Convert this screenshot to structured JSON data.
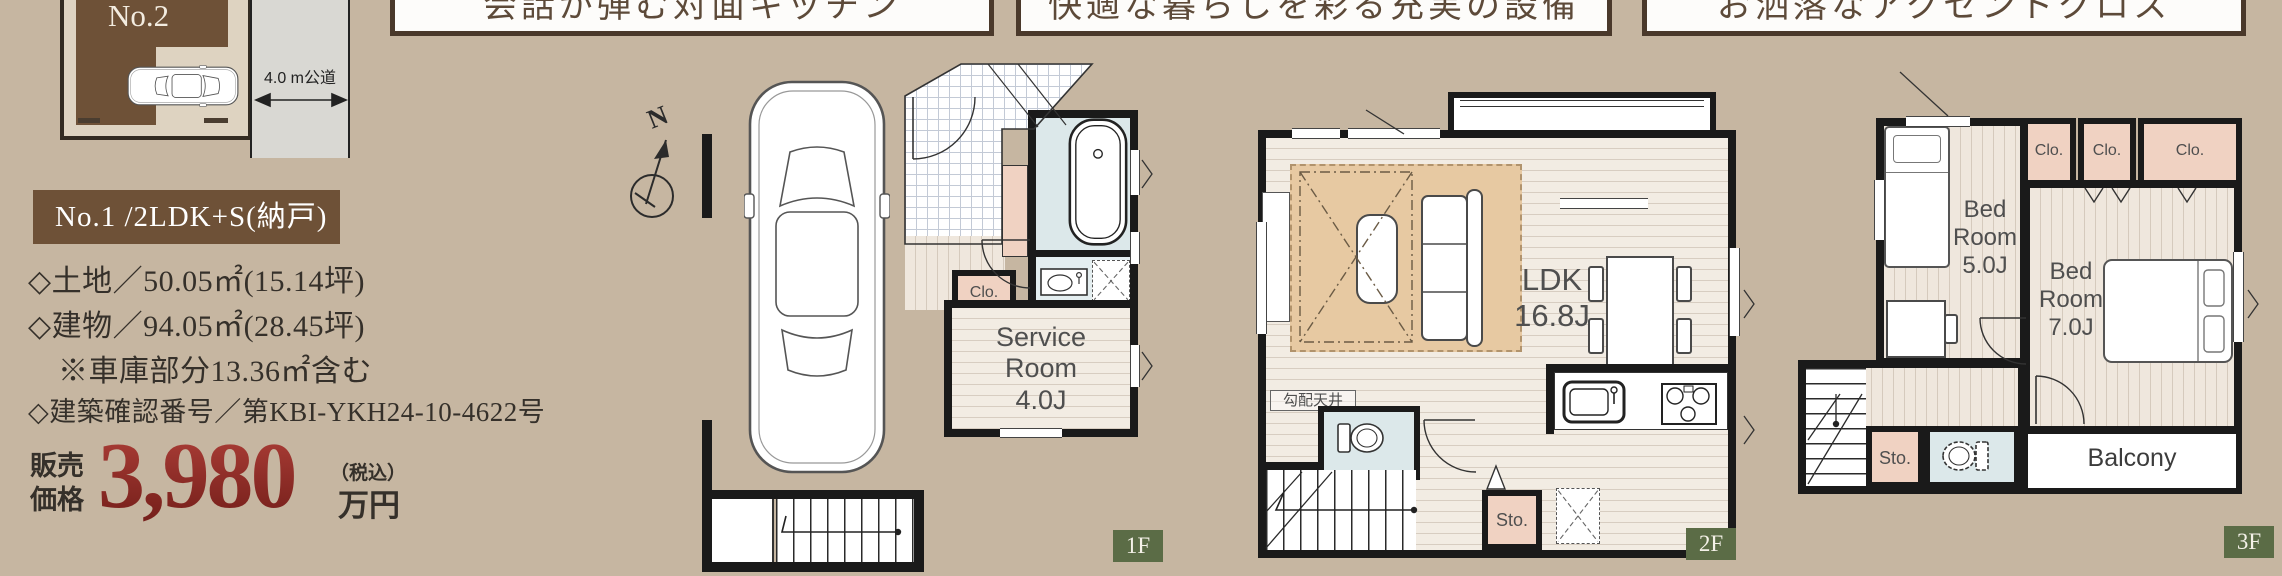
{
  "site_plan": {
    "lot_label": "No.2",
    "road_label": "4.0 m公道"
  },
  "feature_banners": [
    {
      "label": "会話が弾む対面キッチン"
    },
    {
      "label": "快適な暮らしを彩る充実の設備"
    },
    {
      "label": "お洒落なアクセントクロス"
    }
  ],
  "listing": {
    "unit_banner": "No.1 /2LDK+S(納戸)",
    "land": "◇土地／50.05㎡(15.14坪)",
    "building": "◇建物／94.05㎡(28.45坪)",
    "garage_note": "※車庫部分13.36㎡含む",
    "permit": "◇建築確認番号／第KBI-YKH24-10-4622号",
    "price_prefix": "販売\n価格",
    "price_value": "3,980",
    "price_tax_note": "（税込）",
    "price_unit": "万円"
  },
  "compass": {
    "north_label": "N"
  },
  "floor_1f": {
    "badge": "1F",
    "closet": "Clo.",
    "service_room": "Service\nRoom\n4.0J"
  },
  "floor_2f": {
    "badge": "2F",
    "balcony": "Balcony",
    "ldk": "LDK\n16.8J",
    "sloped_ceiling": "勾配天井",
    "storage": "Sto."
  },
  "floor_3f": {
    "badge": "3F",
    "bedroom_5": "Bed\nRoom\n5.0J",
    "bedroom_7": "Bed\nRoom\n7.0J",
    "closet_1": "Clo.",
    "closet_2": "Clo.",
    "closet_3": "Clo.",
    "storage": "Sto.",
    "balcony": "Balcony"
  }
}
